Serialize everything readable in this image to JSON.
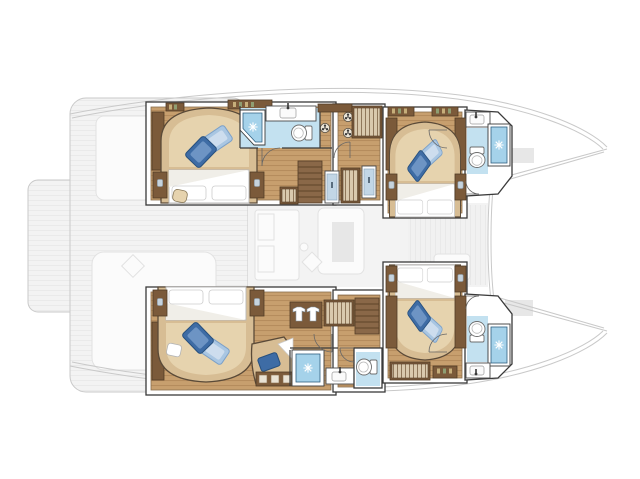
{
  "meta": {
    "label": "Catamaran interior accommodation floor plan, bow to the right: four double cabins with en-suite bathrooms in the two hulls, main deck (cockpit, saloon, swim platform, foredeck) shown ghosted",
    "type": "floor-plan",
    "orientation": "bow-right"
  },
  "canvas": {
    "width": 640,
    "height": 479
  },
  "colors": {
    "wall": "#ffffff",
    "outline": "#3a3a3a",
    "wood": "#c79f6e",
    "wood-line": "#b2885a",
    "tan": "#d7bd94",
    "tan-light": "#e6d3ae",
    "brown": "#7b5a3a",
    "brown-dark": "#523c26",
    "shower-blue": "#a5d2ea",
    "bath-floor": "#c3e1f0",
    "navy": "#2f5f7f",
    "pillow-dark": "#3e6ca5",
    "pillow-dark-edge": "#27507e",
    "pillow-dark-hi": "#6d94c4",
    "pillow-light": "#a9c6e2",
    "pillow-light-edge": "#7ba0c8",
    "pillow-light-hi": "#cdddee",
    "hanger-bg": "#d9c9ad",
    "hanger-line": "#6f5436",
    "lamp": "#c6d3dd",
    "stair": "#8a6848",
    "stair-line": "#5d4429",
    "ghost": "#f3f3f3",
    "ghost-line": "#e8e8e8",
    "ghost-stroke": "#c9c9c9",
    "ghost-obj": "#fbfbfb",
    "ghost-obj-edge": "#e2e2e2",
    "ghost-block": "#e7e7e7",
    "porcelain-edge": "#6e6e6e"
  },
  "legend": {
    "ghosted": "main deck level shown faded: swim platform, aft cockpit, saloon with galley and sofa, foredeck between the bows",
    "highlighted": "hull accommodation level shown in full colour"
  },
  "hulls": [
    {
      "id": "hull-top",
      "label": "port hull",
      "rooms": [
        {
          "id": "aft-cabin",
          "label": "aft double cabin",
          "fixtures": [
            "double-bed",
            "blue-accent-pillows",
            "white-pillows",
            "wardrobe",
            "nightstands-with-lamps",
            "pouf",
            "book-shelves"
          ]
        },
        {
          "id": "aft-bathroom",
          "label": "aft en-suite bathroom",
          "fixtures": [
            "corner-shower",
            "toilet",
            "washbasin-counter"
          ]
        },
        {
          "id": "companionway",
          "label": "companionway corridor",
          "fixtures": [
            "stairs-to-saloon",
            "hanging-lockers",
            "mirror-lockers",
            "deck-hatches"
          ]
        },
        {
          "id": "forward-cabin",
          "label": "forward double cabin",
          "fixtures": [
            "double-bed",
            "blue-accent-pillows",
            "white-pillows",
            "wardrobes",
            "nightstands-with-lamps",
            "book-shelves"
          ]
        },
        {
          "id": "forward-bathroom",
          "label": "forward en-suite bathroom",
          "fixtures": [
            "shower",
            "toilet",
            "washbasin"
          ]
        }
      ]
    },
    {
      "id": "hull-bottom",
      "label": "starboard hull",
      "rooms": [
        {
          "id": "aft-cabin",
          "label": "aft double cabin",
          "fixtures": [
            "double-bed",
            "blue-accent-pillows",
            "white-pillows",
            "wardrobe",
            "nightstands-with-lamps",
            "vanity-chaise-with-pillow",
            "drawer-lockers",
            "vanity-stool"
          ]
        },
        {
          "id": "aft-bathroom",
          "label": "aft en-suite bathroom",
          "fixtures": [
            "large-shower",
            "washbasin-counter",
            "separate-toilet-room"
          ]
        },
        {
          "id": "companionway",
          "label": "companionway corridor",
          "fixtures": [
            "stairs-to-saloon",
            "wardrobe-with-shirts",
            "hanging-locker"
          ]
        },
        {
          "id": "forward-cabin",
          "label": "forward double cabin",
          "fixtures": [
            "double-bed",
            "blue-accent-pillows",
            "white-pillows",
            "wardrobes",
            "nightstands-with-lamps",
            "hanging-locker",
            "shelf"
          ]
        },
        {
          "id": "forward-bathroom",
          "label": "forward en-suite bathroom",
          "fixtures": [
            "shower",
            "toilet",
            "washbasin"
          ]
        }
      ]
    }
  ],
  "ghost_deck": {
    "areas": [
      "swim-platform",
      "aft-cockpit-with-lounges",
      "saloon-with-galley-sofa-and-table",
      "foredeck-between-bows",
      "deck-rails",
      "forward-crossbeam"
    ]
  }
}
